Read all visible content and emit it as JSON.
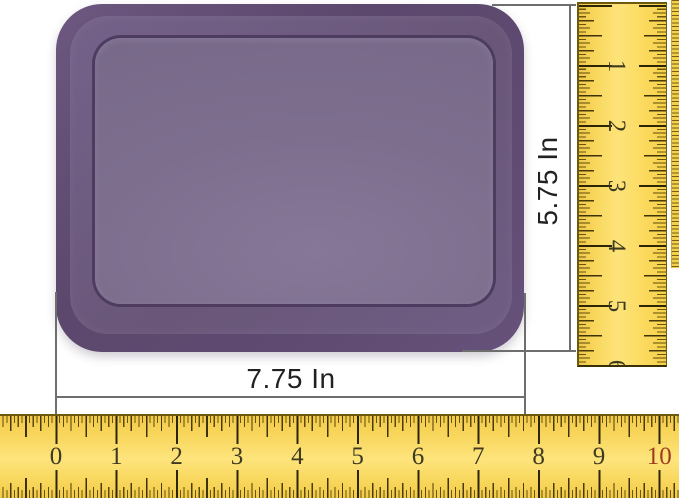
{
  "annotations": {
    "width_label": "7.75 In",
    "height_label": "5.75 In"
  },
  "horizontal_ruler": {
    "numbers": [
      "0",
      "1",
      "2",
      "3",
      "4",
      "5",
      "6",
      "7",
      "8",
      "9",
      "10"
    ]
  },
  "vertical_ruler": {
    "numbers": [
      "1",
      "2",
      "3",
      "4",
      "5",
      "6"
    ]
  },
  "colors": {
    "lid_rim_purple": "#5f4b71",
    "lid_panel_purple": "#7d6e8e",
    "lid_groove_purple": "#4d3c60",
    "ruler_yellow": "#fbd95c",
    "ruler_tick_dark": "#3d3208",
    "ruler_number": "#3e3a22",
    "ruler_number_ten_red": "#9e3c20",
    "dimension_line_gray": "#6e6e6e",
    "dimension_text": "#212121",
    "background": "#ffffff"
  }
}
